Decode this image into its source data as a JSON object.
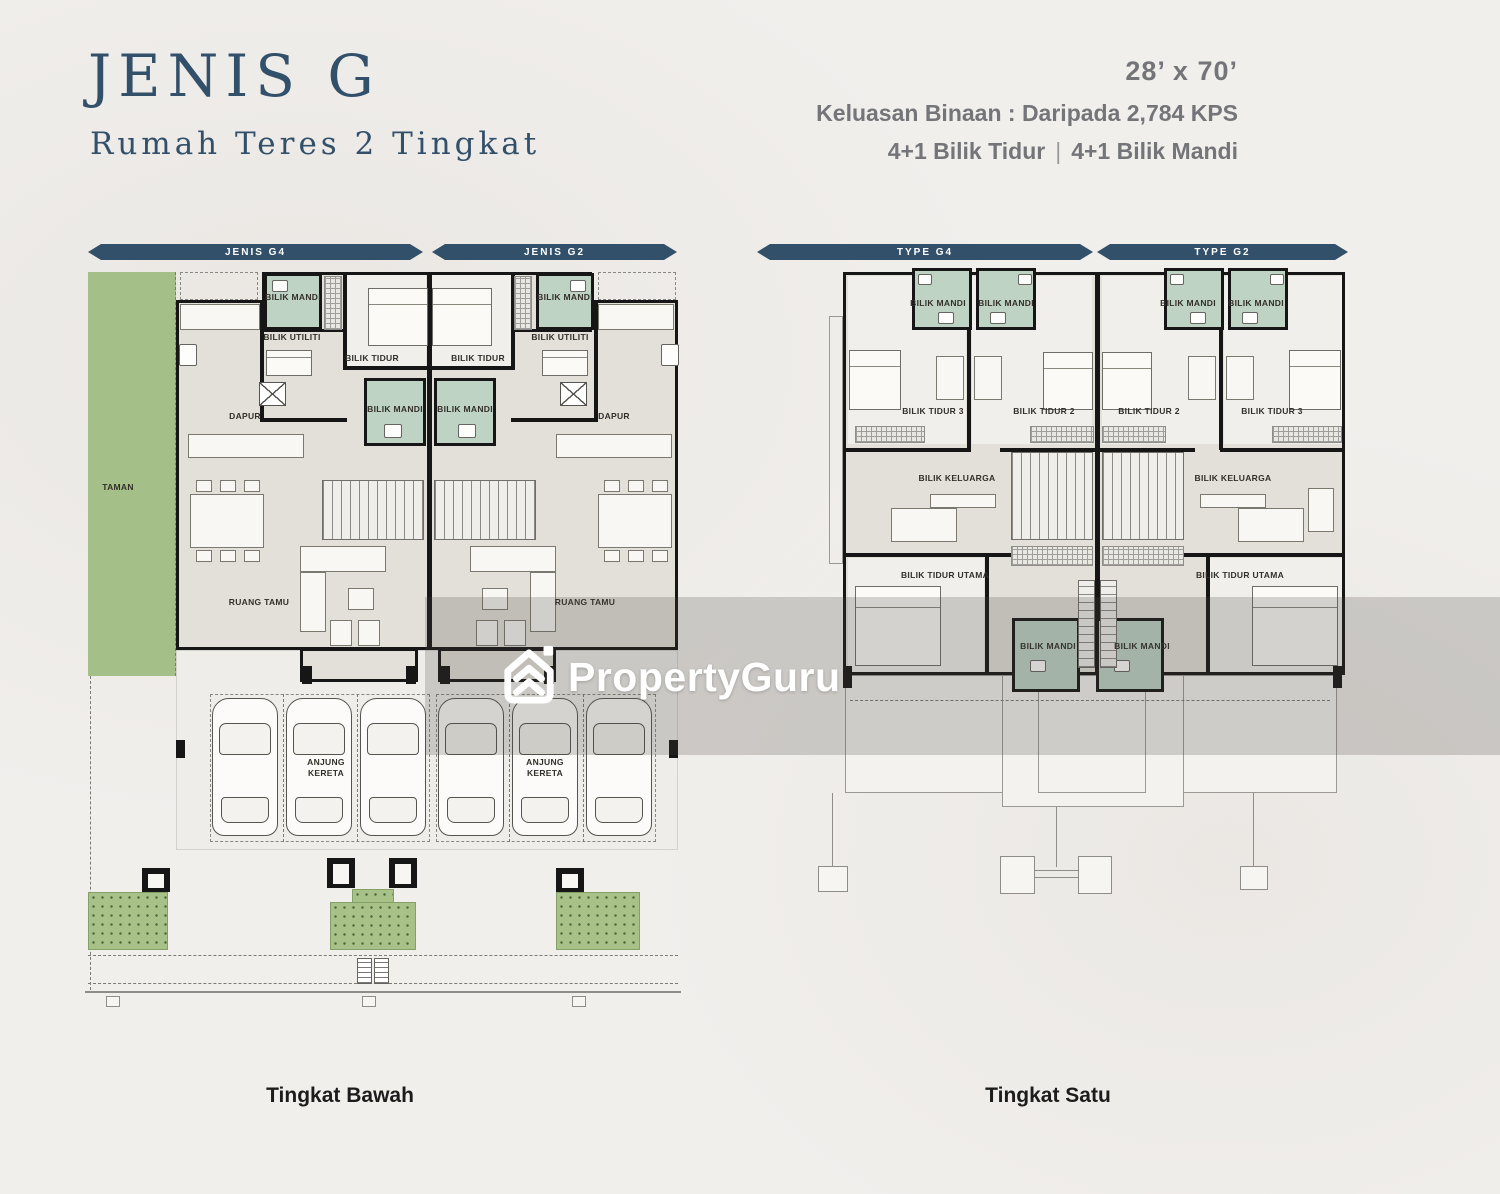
{
  "header": {
    "title": "JENIS G",
    "subtitle": "Rumah Teres 2 Tingkat",
    "size": "28’ x 70’",
    "built_up": "Keluasan Binaan : Daripada 2,784 KPS",
    "bedrooms": "4+1 Bilik Tidur",
    "separator": "|",
    "bathrooms": "4+1 Bilik Mandi"
  },
  "ground_floor": {
    "bars": [
      "JENIS G4",
      "JENIS G2"
    ],
    "caption": "Tingkat Bawah",
    "rooms": {
      "taman": "TAMAN",
      "dapur": "DAPUR",
      "bilik_utiliti": "BILIK UTILITI",
      "bilik_tidur": "BILIK TIDUR",
      "bilik_mandi": "BILIK MANDI",
      "ruang_tamu": "RUANG TAMU",
      "anjung_kereta": "ANJUNG KERETA"
    }
  },
  "first_floor": {
    "bars": [
      "TYPE G4",
      "TYPE G2"
    ],
    "caption": "Tingkat Satu",
    "rooms": {
      "bilik_mandi": "BILIK MANDI",
      "bilik_tidur_2": "BILIK TIDUR 2",
      "bilik_tidur_3": "BILIK TIDUR 3",
      "bilik_keluarga": "BILIK KELUARGA",
      "bilik_tidur_utama": "BILIK TIDUR UTAMA"
    }
  },
  "watermark": {
    "brand": "PropertyGuru"
  },
  "colors": {
    "navy": "#33506b",
    "gray": "#747579",
    "bath": "#bed3c4",
    "garden": "#a4bf87",
    "floor": "#e3e0da",
    "wall": "#161616"
  }
}
